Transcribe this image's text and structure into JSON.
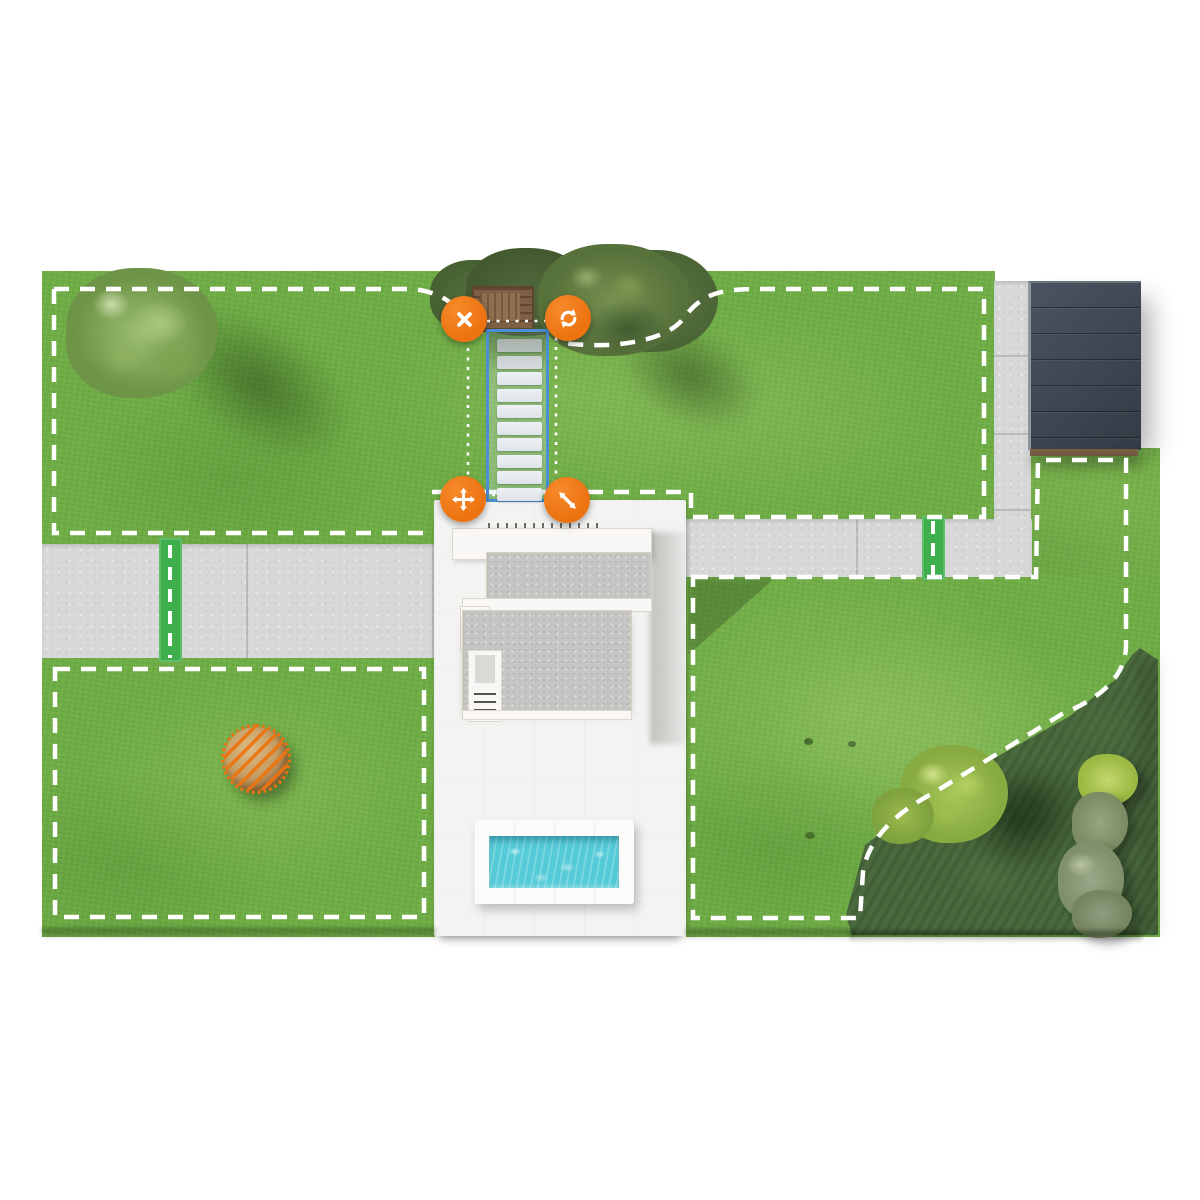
{
  "colors": {
    "accent_orange": "#ed7311",
    "selection_blue": "#4b90d4",
    "corridor_green": "#3fae4c",
    "boundary_white": "#ffffff",
    "grass_green": "#6fad45",
    "planting_dark_green": "#4a6a3e",
    "concrete_path_gray": "#d7d9d8",
    "patio_white": "#f3f3f2",
    "shed_roof_dark": "#3d4651",
    "pool_water_teal": "#55cbd9",
    "obstacle_bush_tan": "#c6a066"
  },
  "selection": {
    "kind": "stepping-stone-path-zone",
    "stepping_stones_count": 10,
    "handles": [
      {
        "id": "delete",
        "icon": "close-icon"
      },
      {
        "id": "rotate",
        "icon": "rotate-icon"
      },
      {
        "id": "move",
        "icon": "move-icon"
      },
      {
        "id": "resize",
        "icon": "resize-icon"
      }
    ]
  },
  "map": {
    "lawn_zones_count": 4,
    "transfer_corridors_count": 2,
    "obstacle_markers_count": 1,
    "pools_count": 1
  }
}
